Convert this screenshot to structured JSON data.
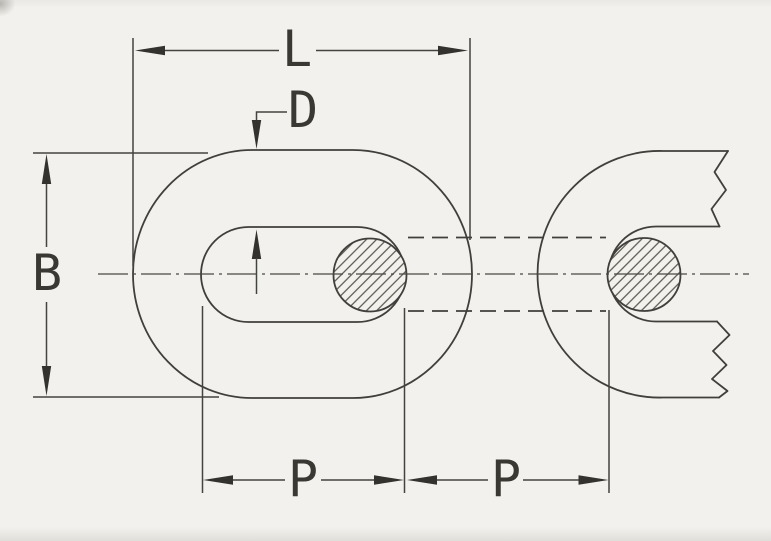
{
  "drawing": {
    "labels": {
      "length": "L",
      "wire_diameter": "D",
      "breadth": "B",
      "pitch_left": "P",
      "pitch_right": "P"
    },
    "colors": {
      "paper": "#f2f1ed",
      "line": "#413f3b",
      "arrow": "#34322e"
    }
  }
}
